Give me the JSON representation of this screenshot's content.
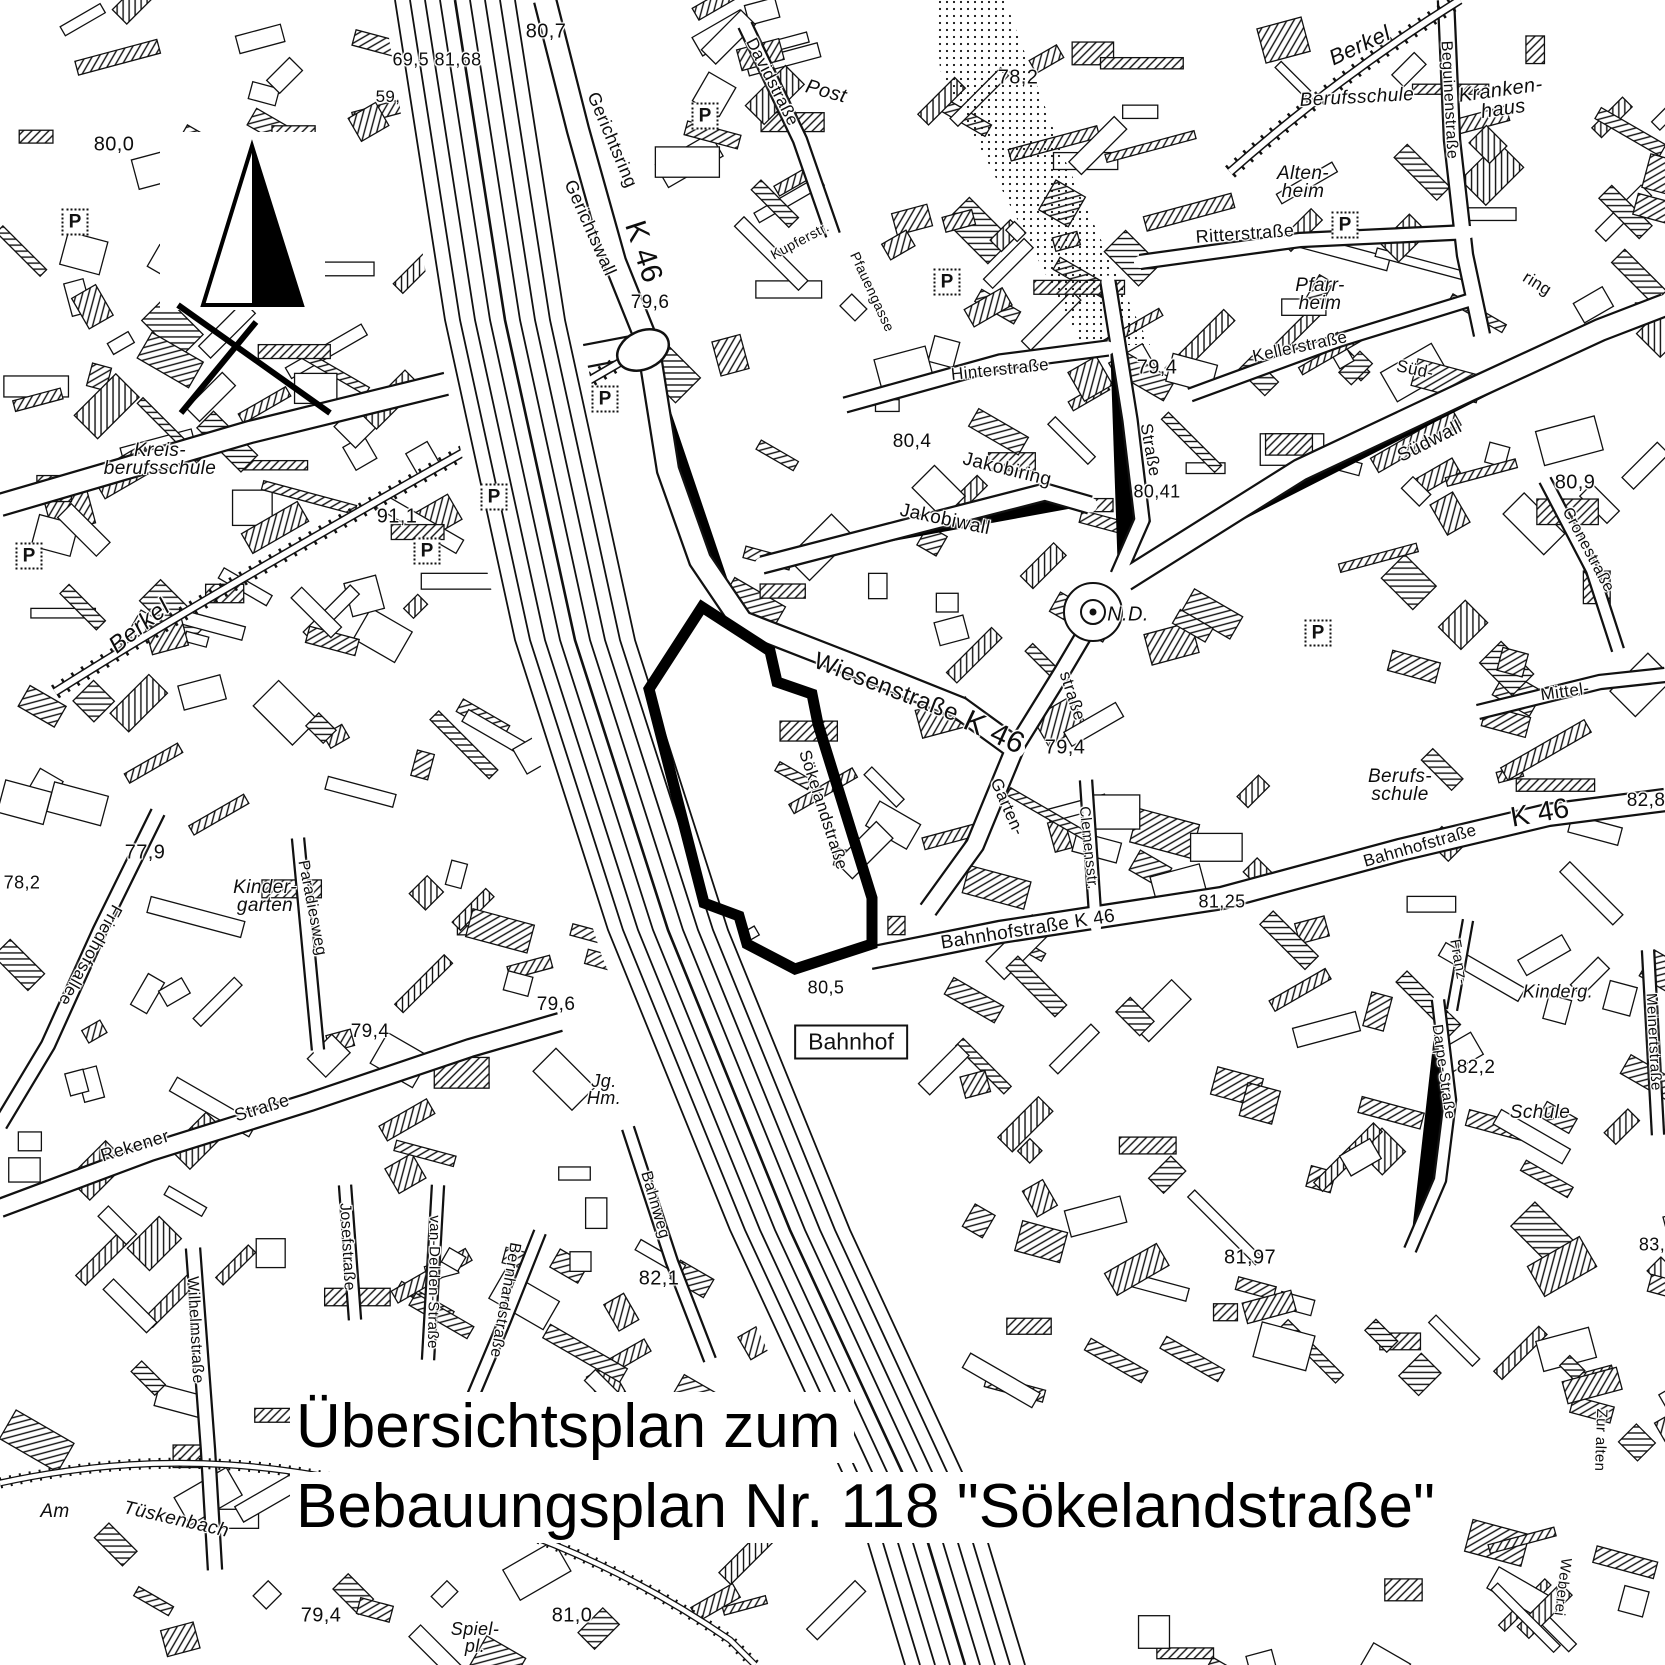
{
  "title": {
    "line1": "Übersichtsplan zum",
    "line2": "Bebauungsplan Nr. 118 \"Sökelandstraße\""
  },
  "station": {
    "label": "Bahnhof"
  },
  "colors": {
    "ink": "#111111",
    "paper": "#ffffff"
  },
  "map": {
    "parking_label": "P",
    "parking": [
      {
        "x": 75,
        "y": 222
      },
      {
        "x": 29,
        "y": 556
      },
      {
        "x": 427,
        "y": 551
      },
      {
        "x": 494,
        "y": 497
      },
      {
        "x": 605,
        "y": 399
      },
      {
        "x": 705,
        "y": 116
      },
      {
        "x": 947,
        "y": 282
      },
      {
        "x": 1345,
        "y": 225
      },
      {
        "x": 1318,
        "y": 633
      }
    ],
    "labels": [
      {
        "t": "80,0",
        "x": 114,
        "y": 145,
        "s": 20
      },
      {
        "t": "69,5 81,68",
        "x": 437,
        "y": 60,
        "s": 18
      },
      {
        "t": "59,",
        "x": 388,
        "y": 97,
        "s": 17
      },
      {
        "t": "80,7",
        "x": 546,
        "y": 32,
        "s": 20
      },
      {
        "t": "Gerichtsring",
        "x": 612,
        "y": 140,
        "r": 67,
        "s": 18
      },
      {
        "t": "Gerichtswall",
        "x": 590,
        "y": 228,
        "r": 66,
        "s": 18
      },
      {
        "t": "K 46",
        "x": 643,
        "y": 252,
        "r": 72,
        "s": 30
      },
      {
        "t": "Davidstraße",
        "x": 772,
        "y": 82,
        "r": 63,
        "s": 17
      },
      {
        "t": "Post",
        "x": 826,
        "y": 92,
        "r": 15,
        "s": 20,
        "it": true
      },
      {
        "t": "78,2",
        "x": 1018,
        "y": 78,
        "s": 20
      },
      {
        "t": "Kupferstr.",
        "x": 800,
        "y": 241,
        "r": -28,
        "s": 14
      },
      {
        "t": "Pfauengasse",
        "x": 872,
        "y": 292,
        "r": 65,
        "s": 14
      },
      {
        "t": "Ritterstraße",
        "x": 1245,
        "y": 234,
        "r": -4,
        "s": 18
      },
      {
        "t": "Alten-\nheim",
        "x": 1303,
        "y": 183,
        "s": 19,
        "it": true
      },
      {
        "t": "Berufsschule",
        "x": 1357,
        "y": 98,
        "r": -3,
        "s": 19,
        "it": true
      },
      {
        "t": "Kranken-\nhaus",
        "x": 1502,
        "y": 100,
        "r": -8,
        "s": 20,
        "it": true
      },
      {
        "t": "Berkel",
        "x": 1360,
        "y": 46,
        "r": -25,
        "s": 22,
        "it": true
      },
      {
        "t": "Beguinenstraße",
        "x": 1449,
        "y": 100,
        "r": 87,
        "s": 16
      },
      {
        "t": "Pfarr-\nheim",
        "x": 1320,
        "y": 295,
        "s": 19,
        "it": true
      },
      {
        "t": "ring",
        "x": 1537,
        "y": 284,
        "r": 32,
        "s": 17
      },
      {
        "t": "Süd-",
        "x": 1415,
        "y": 370,
        "r": 12,
        "s": 17
      },
      {
        "t": "Südwall",
        "x": 1430,
        "y": 442,
        "r": -27,
        "s": 19
      },
      {
        "t": "Kellerstraße",
        "x": 1300,
        "y": 347,
        "r": -12,
        "s": 17
      },
      {
        "t": "Hinterstraße",
        "x": 1000,
        "y": 370,
        "r": -6,
        "s": 17
      },
      {
        "t": "79,4",
        "x": 1157,
        "y": 368,
        "s": 20
      },
      {
        "t": "80,4",
        "x": 912,
        "y": 442,
        "s": 19
      },
      {
        "t": "Jakobiring",
        "x": 1007,
        "y": 470,
        "r": 14,
        "s": 19
      },
      {
        "t": "Jakobiwall",
        "x": 945,
        "y": 520,
        "r": 12,
        "s": 19
      },
      {
        "t": "Straße",
        "x": 1150,
        "y": 450,
        "r": 80,
        "s": 17
      },
      {
        "t": "80,41",
        "x": 1157,
        "y": 492,
        "s": 18
      },
      {
        "t": "80,9",
        "x": 1575,
        "y": 483,
        "s": 20
      },
      {
        "t": "Cronestraße",
        "x": 1588,
        "y": 550,
        "r": 62,
        "s": 16
      },
      {
        "t": "N.D.",
        "x": 1128,
        "y": 615,
        "s": 20,
        "it": true
      },
      {
        "t": "91,1",
        "x": 397,
        "y": 517,
        "s": 20
      },
      {
        "t": "Berkel",
        "x": 140,
        "y": 627,
        "r": -39,
        "s": 24,
        "it": true
      },
      {
        "t": "Kreis-\nberufsschule",
        "x": 160,
        "y": 460,
        "s": 19,
        "it": true
      },
      {
        "t": "Wiesenstraße",
        "x": 886,
        "y": 688,
        "r": 21,
        "s": 24
      },
      {
        "t": "K 46",
        "x": 994,
        "y": 733,
        "r": 25,
        "s": 30
      },
      {
        "t": "Sökelandstraße",
        "x": 823,
        "y": 810,
        "r": 72,
        "s": 17
      },
      {
        "t": "Garten-",
        "x": 1007,
        "y": 807,
        "r": 66,
        "s": 17
      },
      {
        "t": "straße",
        "x": 1072,
        "y": 696,
        "r": 72,
        "s": 17
      },
      {
        "t": "79,4",
        "x": 1065,
        "y": 748,
        "s": 20
      },
      {
        "t": "Clemensstr.",
        "x": 1088,
        "y": 848,
        "r": 84,
        "s": 15
      },
      {
        "t": "Mittel-",
        "x": 1565,
        "y": 692,
        "r": -8,
        "s": 17
      },
      {
        "t": "Berufs-\nschule",
        "x": 1400,
        "y": 786,
        "s": 19,
        "it": true
      },
      {
        "t": "K 46",
        "x": 1540,
        "y": 813,
        "r": -10,
        "s": 28
      },
      {
        "t": "82,8",
        "x": 1646,
        "y": 801,
        "s": 19
      },
      {
        "t": "Bahnhofstraße",
        "x": 1420,
        "y": 846,
        "r": -16,
        "s": 17
      },
      {
        "t": "Bahnhofstraße  K 46",
        "x": 1028,
        "y": 930,
        "r": -9,
        "s": 19
      },
      {
        "t": "81,25",
        "x": 1222,
        "y": 902,
        "s": 18
      },
      {
        "t": "80,5",
        "x": 826,
        "y": 988,
        "s": 18
      },
      {
        "t": "Franz-",
        "x": 1458,
        "y": 962,
        "r": 80,
        "s": 15
      },
      {
        "t": "Kinderg.",
        "x": 1558,
        "y": 992,
        "s": 18,
        "it": true
      },
      {
        "t": "Meinertstraße",
        "x": 1653,
        "y": 1042,
        "r": 87,
        "s": 15
      },
      {
        "t": "Schule",
        "x": 1540,
        "y": 1113,
        "s": 19,
        "it": true
      },
      {
        "t": "82,2",
        "x": 1476,
        "y": 1068,
        "s": 19
      },
      {
        "t": "Darpe-Straße",
        "x": 1443,
        "y": 1072,
        "r": 82,
        "s": 15
      },
      {
        "t": "81,97",
        "x": 1250,
        "y": 1258,
        "s": 20
      },
      {
        "t": "79,6",
        "x": 650,
        "y": 303,
        "s": 19
      },
      {
        "t": "79,6",
        "x": 556,
        "y": 1005,
        "s": 19
      },
      {
        "t": "Jg.\nHm.",
        "x": 604,
        "y": 1090,
        "s": 18,
        "it": true
      },
      {
        "t": "Bahnweg",
        "x": 655,
        "y": 1205,
        "r": 74,
        "s": 16
      },
      {
        "t": "82,1",
        "x": 659,
        "y": 1279,
        "s": 20
      },
      {
        "t": "77,9",
        "x": 145,
        "y": 853,
        "s": 20
      },
      {
        "t": "78,2",
        "x": 22,
        "y": 883,
        "s": 18
      },
      {
        "t": "Kinder-\ngarten",
        "x": 265,
        "y": 897,
        "s": 19,
        "it": true
      },
      {
        "t": "Paradiesweg",
        "x": 312,
        "y": 908,
        "r": 79,
        "s": 16
      },
      {
        "t": "Friedhofsallee",
        "x": 90,
        "y": 955,
        "r": 119,
        "s": 17
      },
      {
        "t": "79,4",
        "x": 370,
        "y": 1032,
        "s": 19
      },
      {
        "t": "Rekener",
        "x": 135,
        "y": 1146,
        "r": -17,
        "s": 18
      },
      {
        "t": "Straße",
        "x": 262,
        "y": 1108,
        "r": -17,
        "s": 18
      },
      {
        "t": "Wilhelmstraße",
        "x": 195,
        "y": 1330,
        "r": 87,
        "s": 16
      },
      {
        "t": "Josefstraße",
        "x": 347,
        "y": 1247,
        "r": 87,
        "s": 16
      },
      {
        "t": "van-Delden-Straße",
        "x": 433,
        "y": 1282,
        "r": 91,
        "s": 15
      },
      {
        "t": "Bernhardstraße",
        "x": 505,
        "y": 1300,
        "r": 100,
        "s": 16
      },
      {
        "t": "Am",
        "x": 55,
        "y": 1512,
        "s": 19,
        "it": true
      },
      {
        "t": "Tüskenbach",
        "x": 176,
        "y": 1520,
        "r": 13,
        "s": 19,
        "it": true
      },
      {
        "t": "79,4",
        "x": 321,
        "y": 1616,
        "s": 20
      },
      {
        "t": "Spiel-\npl.",
        "x": 475,
        "y": 1638,
        "s": 18,
        "it": true
      },
      {
        "t": "81,0",
        "x": 572,
        "y": 1616,
        "s": 20
      },
      {
        "t": "Zur alten",
        "x": 1600,
        "y": 1440,
        "r": 92,
        "s": 15
      },
      {
        "t": "Weberei",
        "x": 1562,
        "y": 1587,
        "r": 97,
        "s": 15
      },
      {
        "t": "83,",
        "x": 1652,
        "y": 1245,
        "s": 18
      }
    ]
  }
}
